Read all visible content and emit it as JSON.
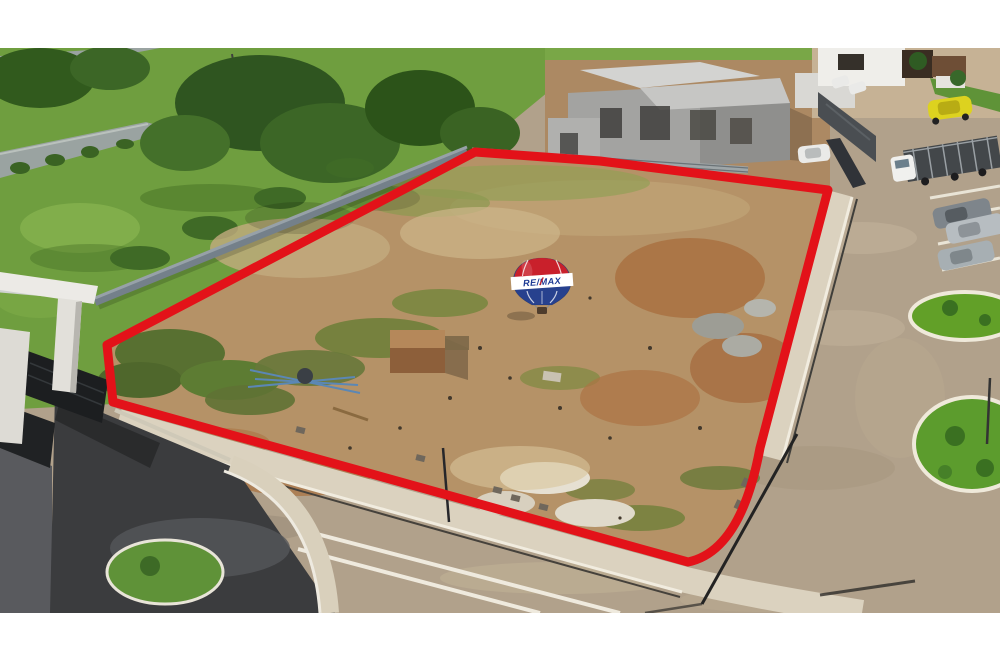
{
  "photo": {
    "kind": "aerial-drone-photo",
    "subject": "Vacant residential land lot outlined in red inside a gated community, with paver streets, entrance gate, construction house and parked vehicles",
    "frame_background": "#ffffff"
  },
  "boundary": {
    "color": "#e31219",
    "style": "thick solid red outline"
  },
  "watermark": {
    "brand": "RE/MAX",
    "top_color": "#c9202b",
    "band_color": "#ffffff",
    "bottom_color": "#27418e",
    "text_color": "#1d3a94"
  },
  "colors": {
    "lot_dirt": "#b59267",
    "park_grass": "#6f9e3f",
    "paver_road": "#b1a18b",
    "sidewalk": "#dbd2bf",
    "asphalt_driveway": "#3b3c3e",
    "privacy_wall": "#74808a",
    "construction_concrete": "#a3a3a1"
  },
  "vehicles": {
    "yellow_car": "#ddd21f",
    "white_truck_cab": "#f0f0ee",
    "gray_suv": "#7e858b",
    "silver_pickup": "#b7bdc1",
    "silver_suv": "#a7afb3",
    "white_car": "#eaeae8"
  }
}
